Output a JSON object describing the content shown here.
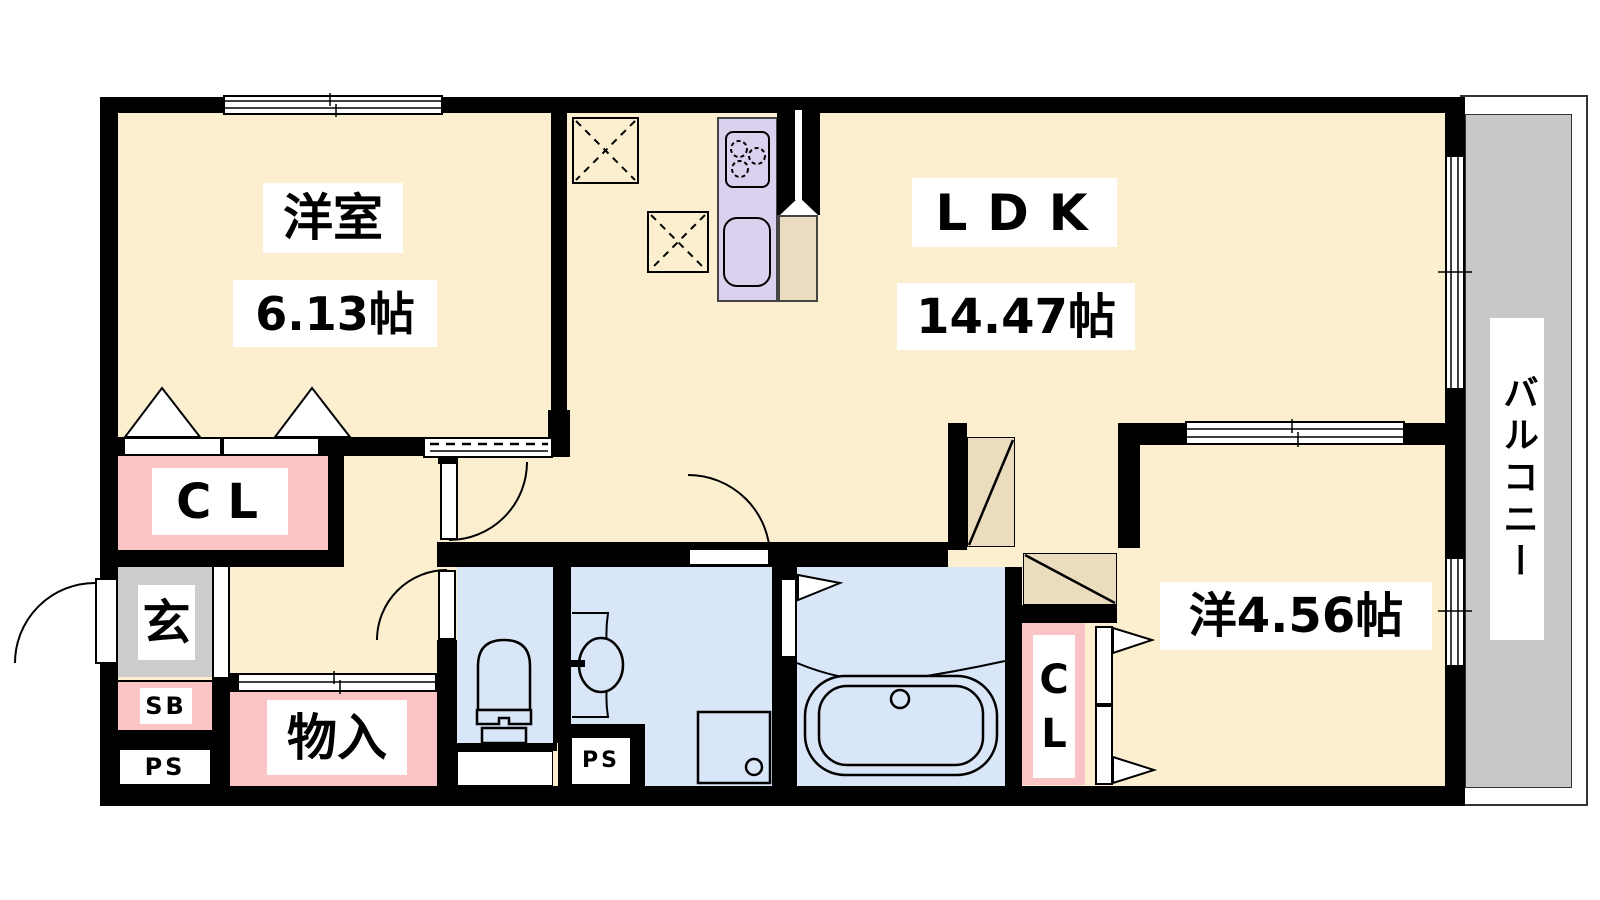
{
  "plan": {
    "type": "floor-plan",
    "rooms": [
      {
        "id": "bedroom-1",
        "name": "洋室",
        "size": "6.13帖"
      },
      {
        "id": "ldk",
        "name": "LDK",
        "size": "14.47帖"
      },
      {
        "id": "bedroom-2",
        "name": "洋4.56帖"
      },
      {
        "id": "closet-1",
        "name": "CL"
      },
      {
        "id": "closet-2",
        "name_line1": "C",
        "name_line2": "L"
      },
      {
        "id": "entrance",
        "name": "玄"
      },
      {
        "id": "shoe-box",
        "name": "SB"
      },
      {
        "id": "pipe-space-left",
        "name": "PS"
      },
      {
        "id": "pipe-space-center",
        "name": "PS"
      },
      {
        "id": "storage",
        "name": "物入"
      },
      {
        "id": "balcony",
        "name": "バルコニー"
      }
    ],
    "labels": {
      "bedroom1_name": "洋室",
      "bedroom1_size": "6.13帖",
      "ldk_name": "LDK",
      "ldk_size": "14.47帖",
      "bedroom2": "洋4.56帖",
      "closet1": "CL",
      "closet2_line1": "C",
      "closet2_line2": "L",
      "entrance": "玄",
      "shoe_box": "SB",
      "ps_left": "PS",
      "ps_center": "PS",
      "storage": "物入",
      "balcony": "バルコニー"
    },
    "fixtures": [
      "kitchen-counter",
      "stove",
      "kitchen-sink",
      "refrigerator-space",
      "upper-cabinet",
      "toilet",
      "vanity-sink",
      "washing-machine-pan",
      "bathtub"
    ],
    "colors": {
      "room_cream": "#FBEFD0",
      "closet_pink": "#FAC3C6",
      "wet_area_blue": "#D8E6F7",
      "kitchen_lavender": "#DBD0ED",
      "door_swing_beige": "#EADCBD",
      "entrance_gray": "#CCCCCC",
      "balcony_gray": "#C8C8C8",
      "wall_black": "#000000",
      "label_bg": "#FFFFFF"
    }
  }
}
